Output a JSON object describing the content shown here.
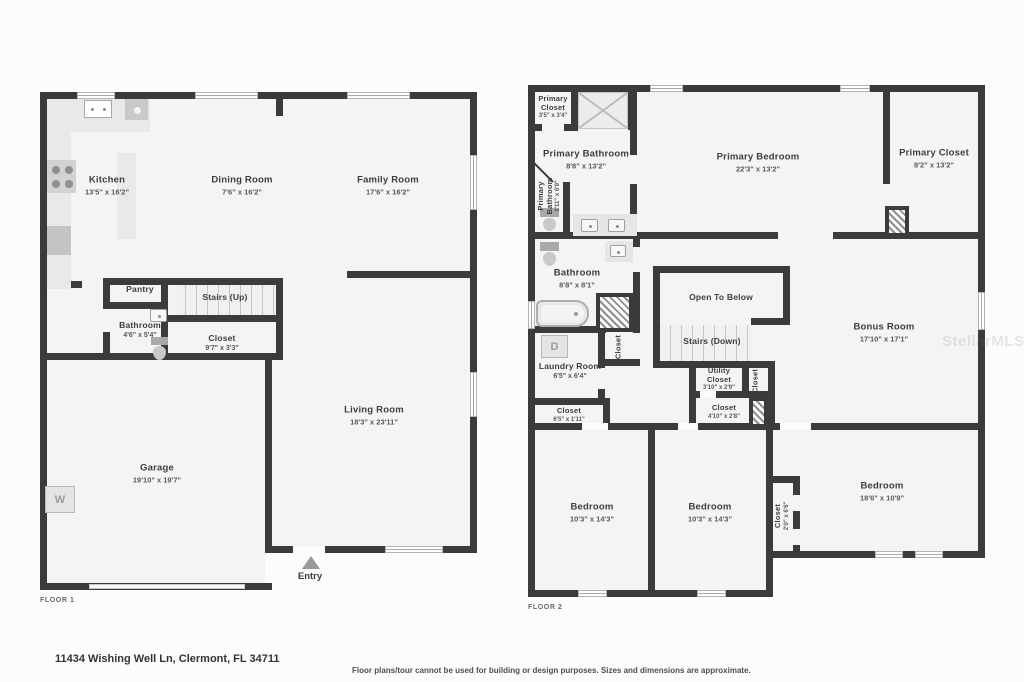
{
  "address": "11434 Wishing Well Ln, Clermont, FL 34711",
  "disclaimer": "Floor plans/tour cannot be used for building or design purposes. Sizes and dimensions are approximate.",
  "watermark": "StellarMLS",
  "floor1": {
    "label": "FLOOR 1",
    "entry": "Entry",
    "washer": "W",
    "rooms": {
      "kitchen": {
        "name": "Kitchen",
        "dims": "13'5\" x 16'2\""
      },
      "dining": {
        "name": "Dining Room",
        "dims": "7'6\" x 16'2\""
      },
      "family": {
        "name": "Family Room",
        "dims": "17'6\" x 16'2\""
      },
      "pantry": {
        "name": "Pantry",
        "dims": ""
      },
      "stairs_up": {
        "name": "Stairs (Up)",
        "dims": ""
      },
      "bathroom": {
        "name": "Bathroom",
        "dims": "4'6\" x 5'4\""
      },
      "closet": {
        "name": "Closet",
        "dims": "9'7\" x 3'3\""
      },
      "living": {
        "name": "Living Room",
        "dims": "18'3\" x 23'11\""
      },
      "garage": {
        "name": "Garage",
        "dims": "19'10\" x 19'7\""
      }
    }
  },
  "floor2": {
    "label": "FLOOR 2",
    "dryer": "D",
    "rooms": {
      "primary_closet_small": {
        "name": "Primary Closet",
        "dims": "3'5\" x 3'4\""
      },
      "primary_bathroom": {
        "name": "Primary Bathroom",
        "dims": "8'8\" x 13'2\""
      },
      "primary_bathroom_small": {
        "name": "Primary Bathroom",
        "dims": "2'11\" x 6'9\""
      },
      "primary_bedroom": {
        "name": "Primary Bedroom",
        "dims": "22'3\" x 13'2\""
      },
      "primary_closet": {
        "name": "Primary Closet",
        "dims": "8'2\" x 13'2\""
      },
      "bathroom": {
        "name": "Bathroom",
        "dims": "8'8\" x 8'1\""
      },
      "closet_hall": {
        "name": "Closet",
        "dims": ""
      },
      "laundry": {
        "name": "Laundry Room",
        "dims": "6'5\" x 6'4\""
      },
      "closet_laundry": {
        "name": "Closet",
        "dims": "6'5\" x 1'11\""
      },
      "open_below": {
        "name": "Open To Below",
        "dims": ""
      },
      "stairs_down": {
        "name": "Stairs (Down)",
        "dims": ""
      },
      "utility_closet": {
        "name": "Utility Closet",
        "dims": "3'10\" x 2'9\""
      },
      "closet_stairs": {
        "name": "Closet",
        "dims": ""
      },
      "closet_hall2": {
        "name": "Closet",
        "dims": "4'10\" x 2'8\""
      },
      "bonus": {
        "name": "Bonus Room",
        "dims": "17'10\" x 17'1\""
      },
      "bedroom1": {
        "name": "Bedroom",
        "dims": "10'3\" x 14'3\""
      },
      "bedroom2": {
        "name": "Bedroom",
        "dims": "10'3\" x 14'3\""
      },
      "closet_bedroom": {
        "name": "Closet",
        "dims": "2'0\" x 6'6\""
      },
      "bedroom3": {
        "name": "Bedroom",
        "dims": "18'6\" x 10'9\""
      }
    }
  }
}
